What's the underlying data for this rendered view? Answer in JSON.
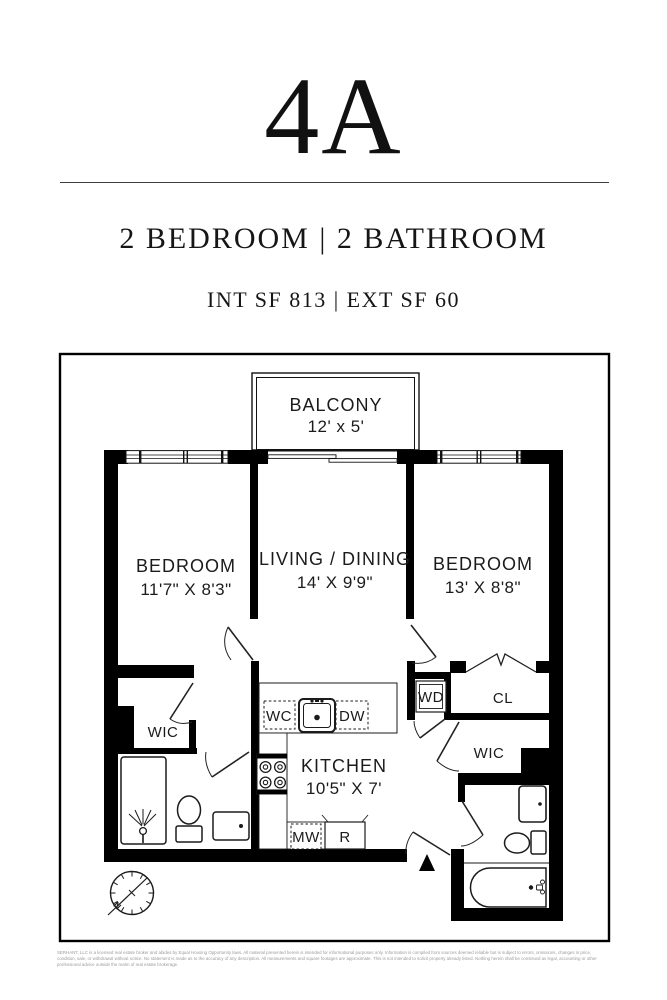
{
  "header": {
    "unit": "4A",
    "subtitle": "2 BEDROOM | 2 BATHROOM",
    "area_line": "INT SF 813 | EXT SF 60"
  },
  "floorplan": {
    "balcony": {
      "name": "BALCONY",
      "dim": "12' x 5'"
    },
    "living": {
      "name": "LIVING / DINING",
      "dim": "14' X 9'9\""
    },
    "bedroom_left": {
      "name": "BEDROOM",
      "dim": "11'7\" X 8'3\""
    },
    "bedroom_right": {
      "name": "BEDROOM",
      "dim": "13' X 8'8\""
    },
    "kitchen": {
      "name": "KITCHEN",
      "dim": "10'5\" X 7'"
    },
    "labels": {
      "wic_left": "WIC",
      "wic_right": "WIC",
      "washer_dryer": "WD",
      "closet": "CL",
      "water_closet": "WC",
      "dishwasher": "DW",
      "microwave": "MW",
      "refrigerator": "R"
    },
    "compass_north": "N"
  },
  "footer": {
    "disclaimer": "SERHANT. LLC is a licensed real estate broker and abides by Equal Housing Opportunity laws. All material presented herein is intended for informational purposes only. Information is compiled from sources deemed reliable but is subject to errors, omissions, changes in price, condition, sale, or withdrawal without notice. No statement is made as to the accuracy of any description. All measurements and square footages are approximate. This is not intended to solicit property already listed. Nothing herein shall be construed as legal, accounting or other professional advice outside the realm of real estate brokerage."
  },
  "colors": {
    "ink": "#111111",
    "wall": "#000000",
    "muted": "#9b9b9b"
  }
}
